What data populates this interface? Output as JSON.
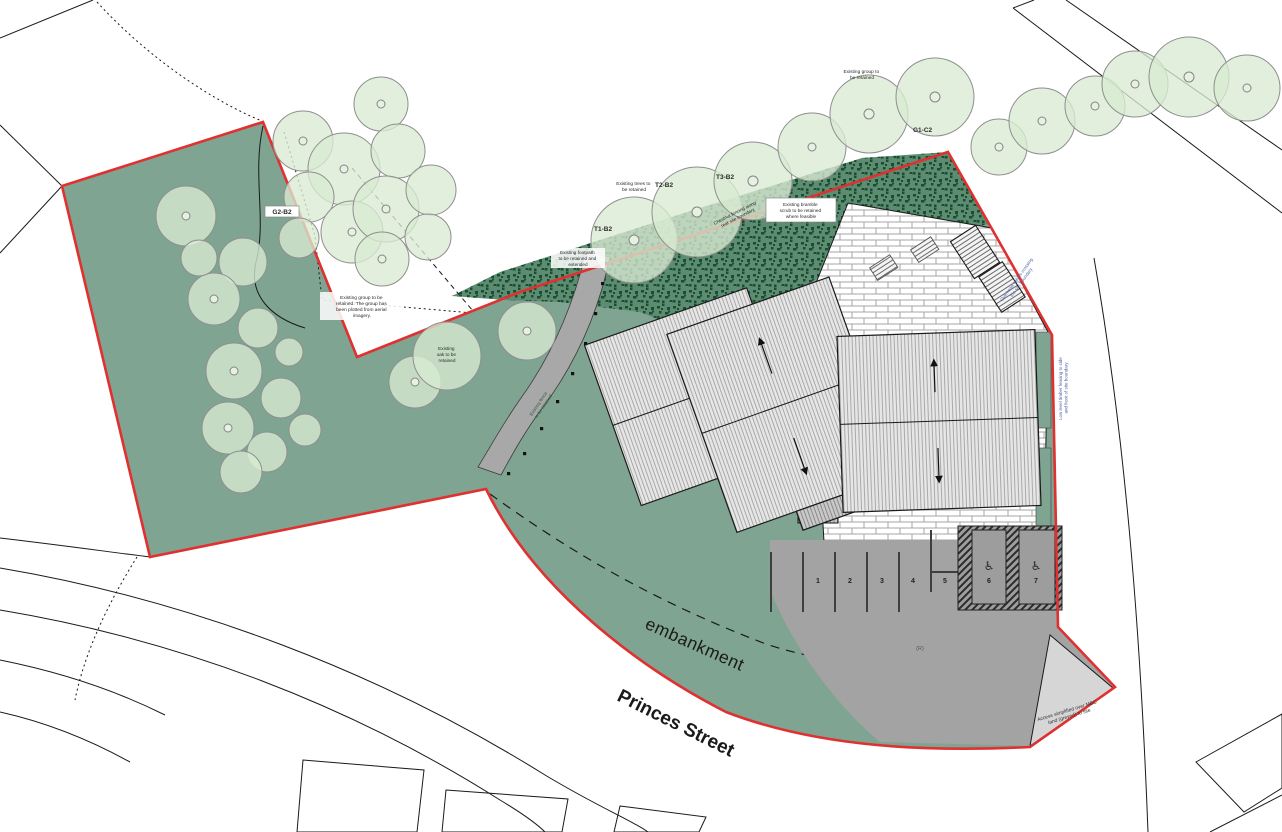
{
  "plan": {
    "streets": {
      "princes": "Princes Street",
      "embankment": "embankment"
    },
    "tree_tags": {
      "t1": "T1-B2",
      "t2": "T2-B2",
      "t3": "T3-B2",
      "g1": "G1-C2",
      "g2": "G2-B2"
    },
    "notes": {
      "group_top": [
        "Existing group to",
        "be retained"
      ],
      "trees_retained": [
        "Existing trees to",
        "be retained"
      ],
      "bramble": [
        "Existing bramble",
        "scrub to be retained",
        "where feasible"
      ],
      "group_aerial": [
        "Existing group to be",
        "retained. The group has",
        "been plotted from aerial",
        "imagery."
      ],
      "oak": [
        "Existing",
        "oak to be",
        "retained"
      ],
      "footpath": [
        "Existing footpath",
        "to be retained and",
        "extended"
      ],
      "fence_rear": [
        "Chestnut fencing along",
        "rear site boundary"
      ],
      "path_fence": [
        "Existing fence",
        "to be retained"
      ],
      "overhead": [
        "Overhead cables crossing",
        "the site boundary"
      ],
      "timber_fence": [
        "Low level timber fencing to side",
        "and front of site boundary"
      ],
      "access": [
        "Access simplified over MBC",
        "land (greyed) to site"
      ]
    },
    "parking": {
      "bays": [
        "1",
        "2",
        "3",
        "4",
        "5",
        "6",
        "7"
      ],
      "accessible_icon": "♿",
      "surface_tag": "(R)"
    },
    "colors": {
      "site_green": "#7FA492",
      "scrub_green": "#17502B",
      "tree_green": "#D9EAD2",
      "boundary_red": "#E03030",
      "tarmac": "#A3A3A3",
      "note_blue": "#5166A8"
    }
  }
}
